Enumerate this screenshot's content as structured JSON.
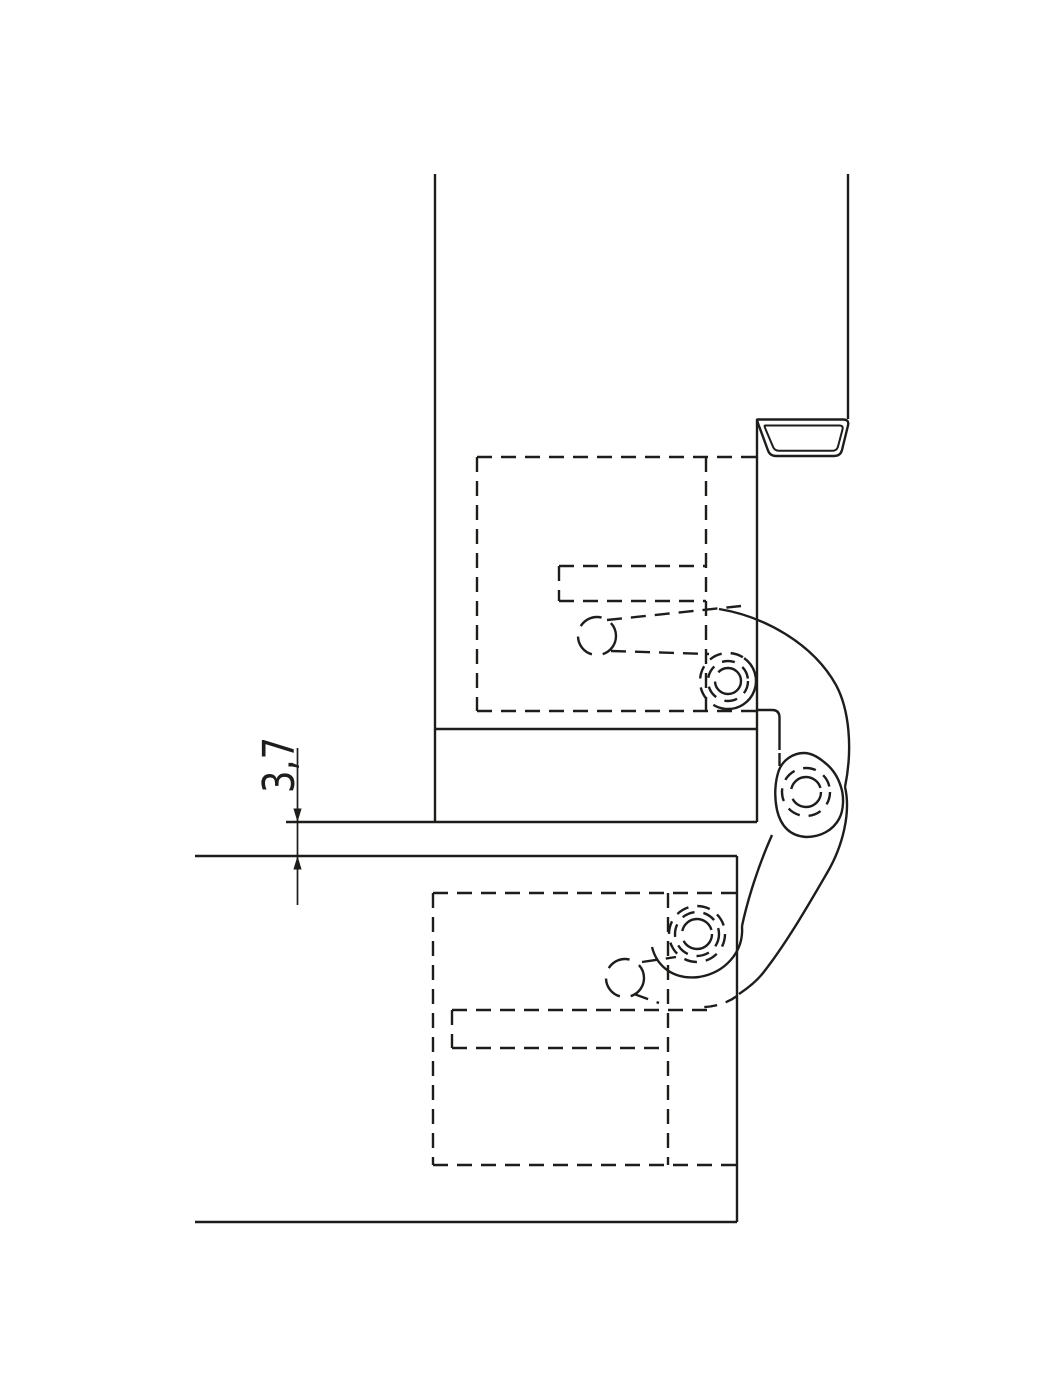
{
  "drawing": {
    "type": "technical-section-concealed-hinge",
    "dimension_label": "3,7",
    "line_color": "#1d1d1b",
    "background_color": "#ffffff"
  }
}
